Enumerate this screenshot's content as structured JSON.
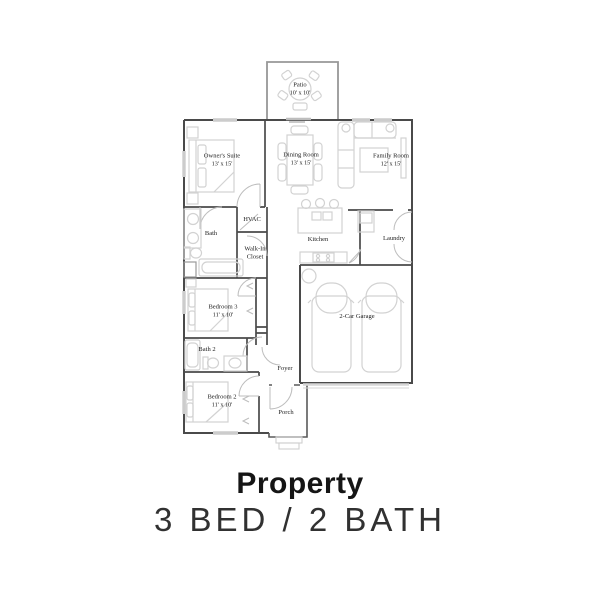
{
  "title": {
    "heading": "Property",
    "subheading": "3 BED / 2 BATH"
  },
  "floorplan": {
    "rooms": [
      {
        "name": "Patio",
        "dims": "10' x 10'"
      },
      {
        "name": "Owner's Suite",
        "dims": "13' x 15'"
      },
      {
        "name": "Dining Room",
        "dims": "13' x 15'"
      },
      {
        "name": "Family Room",
        "dims": "12' x 15'"
      },
      {
        "name": "Bath",
        "dims": ""
      },
      {
        "name": "HVAC",
        "dims": ""
      },
      {
        "name": "Walk-In Closet",
        "dims": ""
      },
      {
        "name": "Kitchen",
        "dims": ""
      },
      {
        "name": "Laundry",
        "dims": ""
      },
      {
        "name": "Bedroom 3",
        "dims": "11' x 10'"
      },
      {
        "name": "2-Car Garage",
        "dims": ""
      },
      {
        "name": "Bath 2",
        "dims": ""
      },
      {
        "name": "Foyer",
        "dims": ""
      },
      {
        "name": "Bedroom 2",
        "dims": "11' x 10'"
      },
      {
        "name": "Porch",
        "dims": ""
      }
    ],
    "colors": {
      "wall": "#4a4a4a",
      "patio_wall": "#979797",
      "furniture": "#d2d2d2",
      "opening": "#bdbdbd",
      "window": "#cccccc",
      "label_text": "#1c1c1c"
    }
  }
}
